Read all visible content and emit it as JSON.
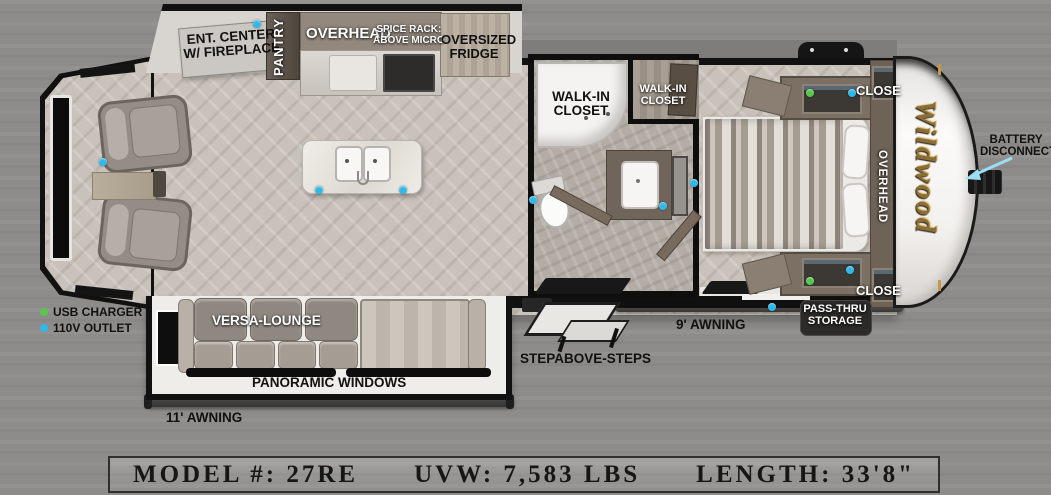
{
  "title_bar": {
    "model": "MODEL #: 27RE",
    "uvw": "UVW: 7,583 LBS",
    "length": "LENGTH: 33'8\""
  },
  "brand": {
    "logo_text": "Wildwood",
    "logo_color": "#8b6d38"
  },
  "legend": {
    "usb_label": "USB CHARGER",
    "outlet_label": "110V OUTLET"
  },
  "labels": {
    "ent_center_line1": "ENT. CENTER",
    "ent_center_line2": "W/ FIREPLACE",
    "pantry": "PANTRY",
    "overhead_kitchen": "OVERHEAD",
    "spice_rack_line1": "SPICE RACK:",
    "spice_rack_line2": "ABOVE MICRO",
    "fridge_line1": "OVERSIZED",
    "fridge_line2": "FRIDGE",
    "walkin_shower_line1": "WALK-IN",
    "walkin_shower_line2": "CLOSET",
    "walkin_closet_line1": "WALK-IN",
    "walkin_closet_line2": "CLOSET",
    "closet_top": "CLOSE",
    "closet_bottom": "CLOSE",
    "overhead_bedroom": "OVERHEAD",
    "battery_line1": "BATTERY",
    "battery_line2": "DISCONNECT",
    "versa_lounge": "VERSA-LOUNGE",
    "panoramic_windows": "PANORAMIC WINDOWS",
    "awning_11": "11' AWNING",
    "steps": "STEPABOVE-STEPS",
    "awning_9": "9' AWNING",
    "passthru_line1": "PASS-THRU",
    "passthru_line2": "STORAGE"
  },
  "outlets": {
    "blue": {
      "color": "#2fb9e8",
      "points": [
        [
          257,
          24
        ],
        [
          103,
          162
        ],
        [
          319,
          190
        ],
        [
          403,
          190
        ],
        [
          533,
          200
        ],
        [
          663,
          206
        ],
        [
          694,
          183
        ],
        [
          852,
          93
        ],
        [
          850,
          270
        ],
        [
          772,
          307
        ]
      ]
    },
    "green": {
      "color": "#57c84d",
      "points": [
        [
          810,
          93
        ],
        [
          810,
          281
        ]
      ]
    }
  }
}
